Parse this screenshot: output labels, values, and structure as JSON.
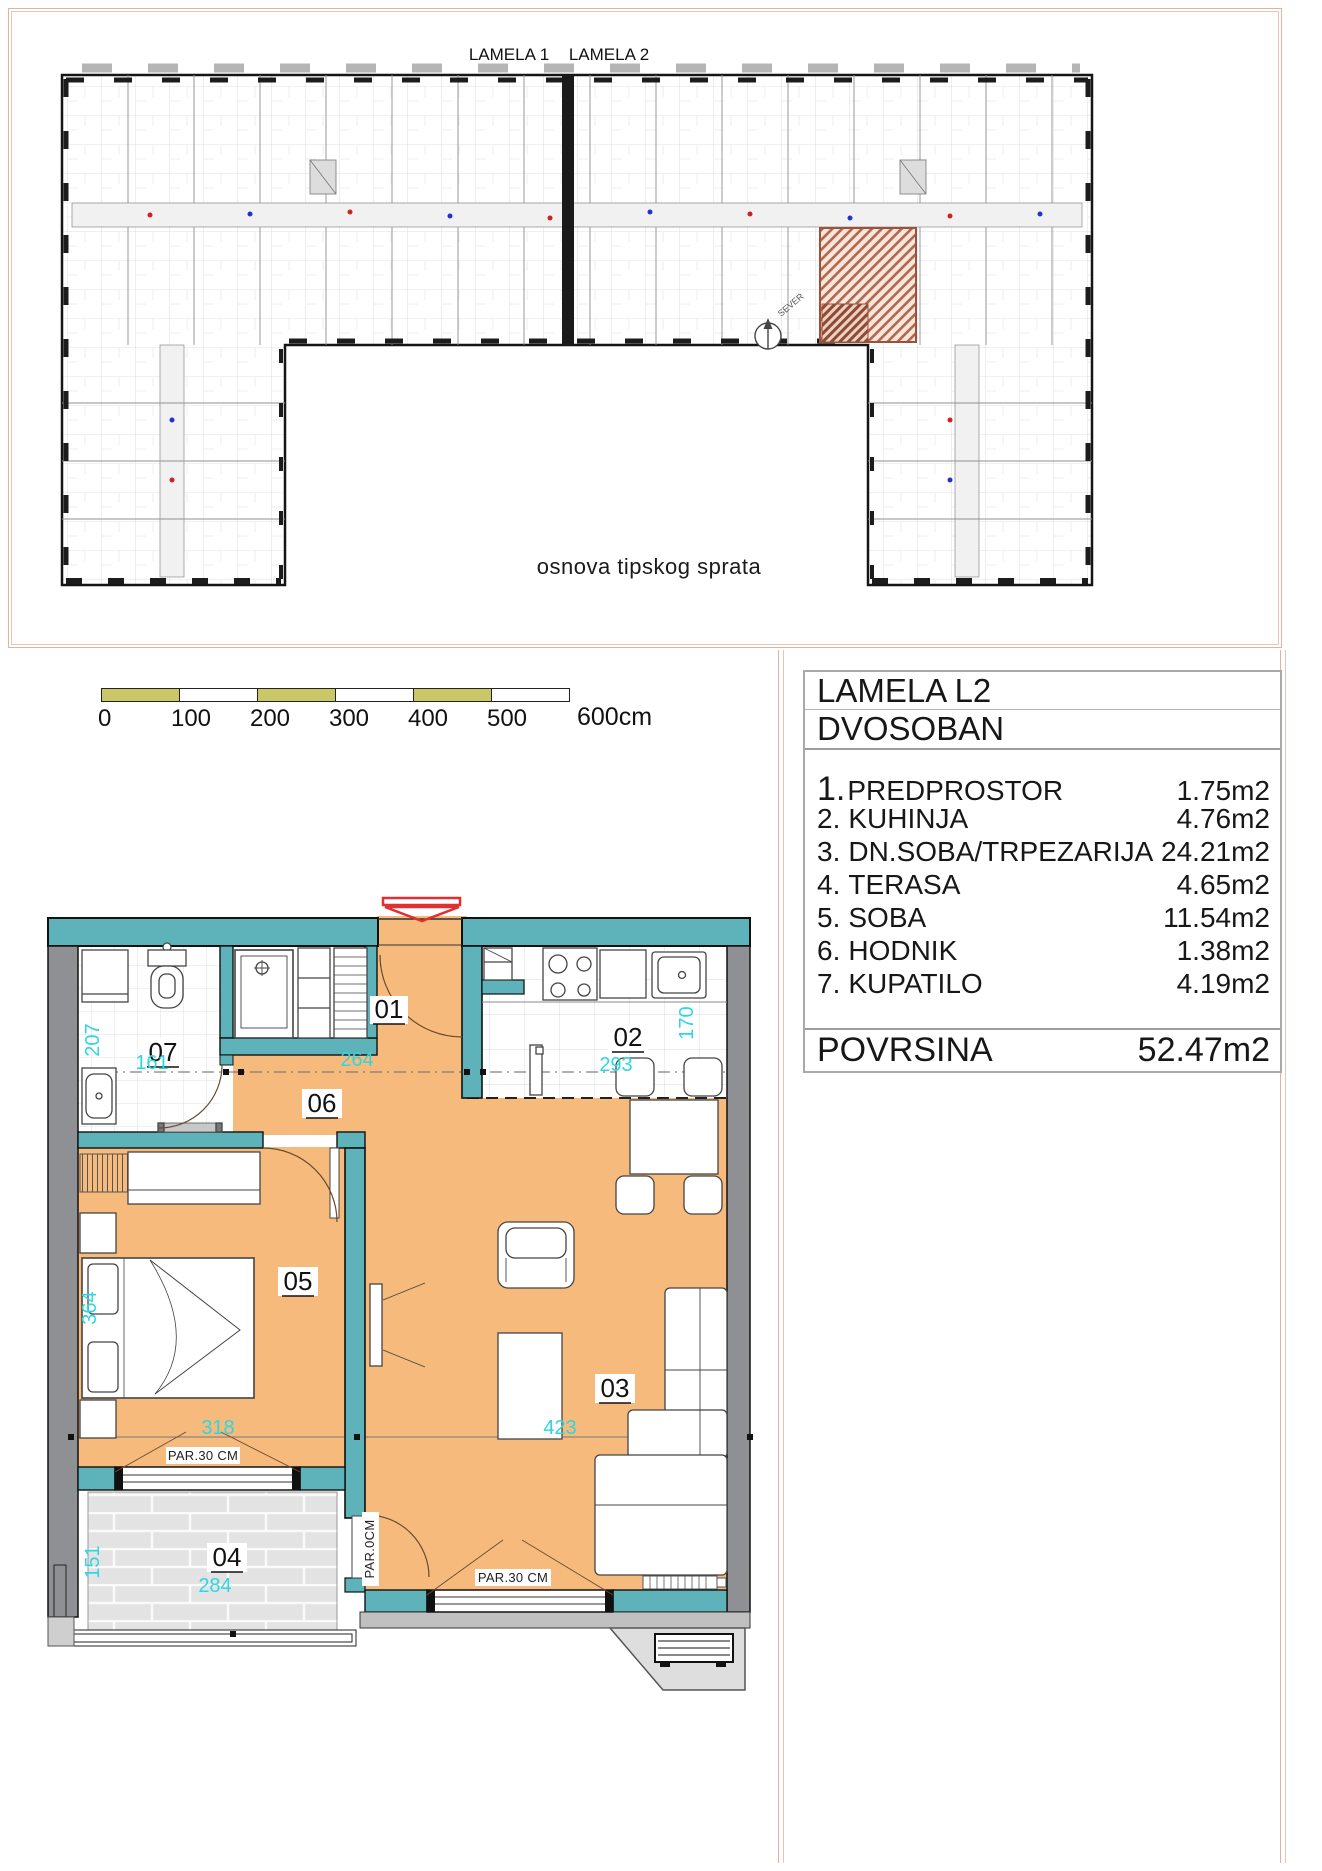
{
  "page": {
    "width": 1322,
    "height": 1871
  },
  "colors": {
    "frame_salmon": "#e2b2a0",
    "floor_orange": "#f6ba7d",
    "wall_teal": "#5eb2ba",
    "wall_gray": "#8f9093",
    "terrace_tile": "#e3e3e3",
    "dim_cyan": "#2fd6e0",
    "entrance_red": "#e03030",
    "scale_olive": "#c9c768",
    "highlight_hatch": "#b2664c"
  },
  "top_plan": {
    "lamela1": "LAMELA 1",
    "lamela2": "LAMELA 2",
    "caption": "osnova tipskog sprata",
    "north_label": "SEVER"
  },
  "scale_bar": {
    "ticks": [
      "0",
      "100",
      "200",
      "300",
      "400",
      "500"
    ],
    "end_label": "600cm"
  },
  "info_panel": {
    "title": "LAMELA L2",
    "subtitle": "DVOSOBAN",
    "rooms": [
      {
        "num": "1.",
        "name": "PREDPROSTOR",
        "area": "1.75m2"
      },
      {
        "num": "2.",
        "name": "KUHINJA",
        "area": "4.76m2"
      },
      {
        "num": "3.",
        "name": "DN.SOBA/TRPEZARIJA",
        "area": "24.21m2"
      },
      {
        "num": "4.",
        "name": "TERASA",
        "area": "4.65m2"
      },
      {
        "num": "5.",
        "name": "SOBA",
        "area": "11.54m2"
      },
      {
        "num": "6.",
        "name": "HODNIK",
        "area": "1.38m2"
      },
      {
        "num": "7.",
        "name": "KUPATILO",
        "area": "4.19m2"
      }
    ],
    "total_label": "POVRSINA",
    "total_value": "52.47m2"
  },
  "apartment": {
    "room_labels": {
      "r01": "01",
      "r02": "02",
      "r03": "03",
      "r04": "04",
      "r05": "05",
      "r06": "06",
      "r07": "07"
    },
    "dims": {
      "bath_h": "207",
      "bath_w": "161",
      "hall_w": "264",
      "kitchen_w": "293",
      "kitchen_h": "170",
      "bed_h": "364",
      "bed_w": "318",
      "living_w": "423",
      "terrace_h": "151",
      "terrace_w": "284"
    },
    "parapets": {
      "bedroom": "PAR.30 CM",
      "terrace_door": "PAR.0CM",
      "living": "PAR.30 CM"
    }
  }
}
